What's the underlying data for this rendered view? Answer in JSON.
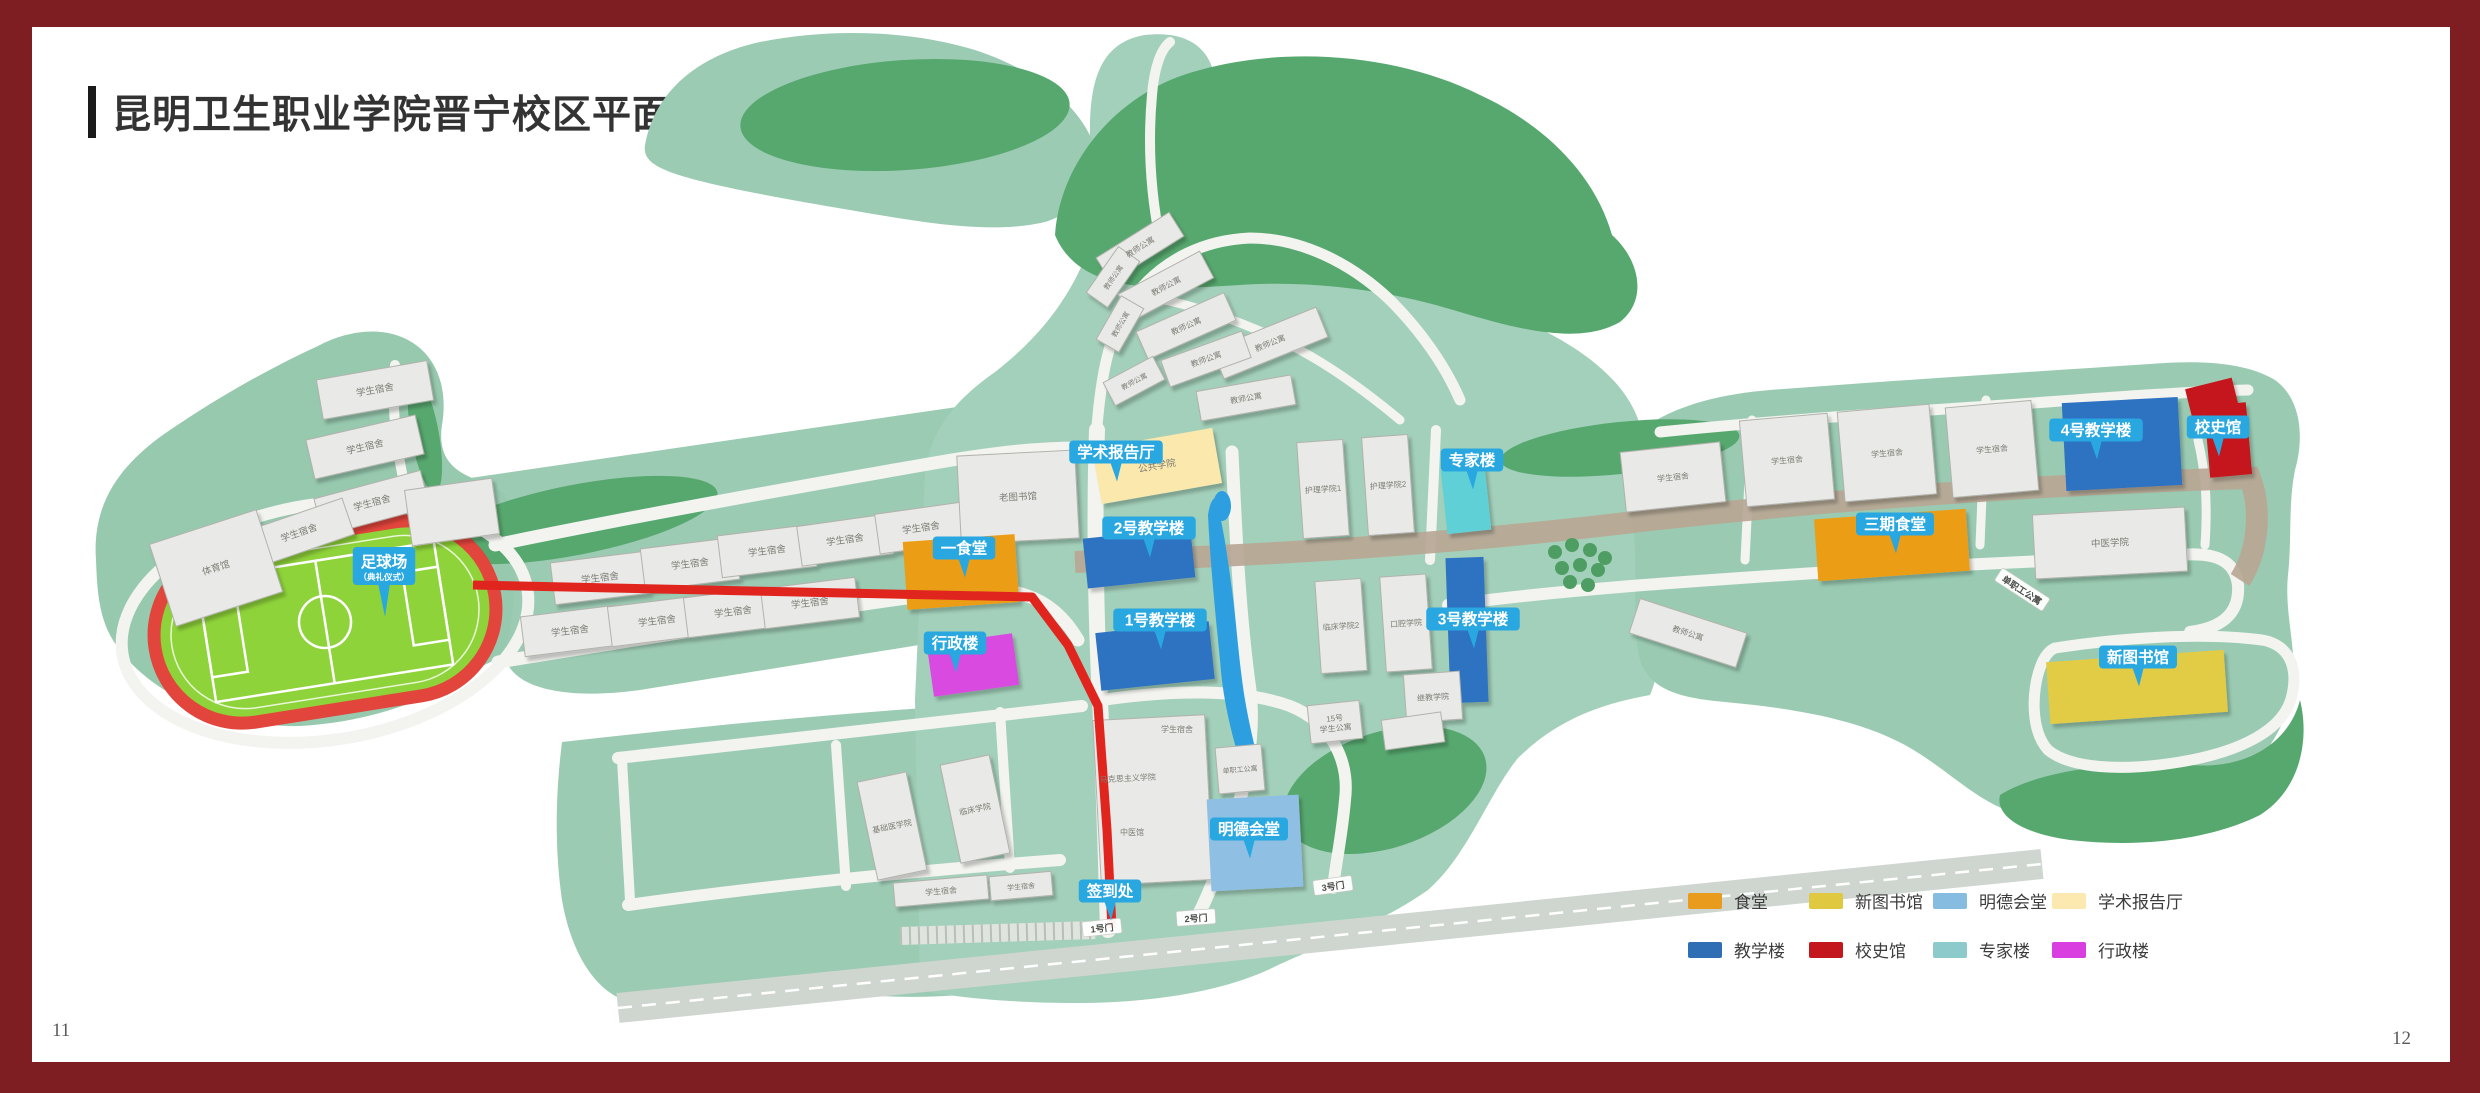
{
  "page": {
    "title": "昆明卫生职业学院晋宁校区平面图",
    "page_left": "11",
    "page_right": "12",
    "frame_color": "#7E1E22"
  },
  "legend": {
    "items": [
      {
        "label": "食堂",
        "color": "#E89B1C"
      },
      {
        "label": "新图书馆",
        "color": "#E0C840"
      },
      {
        "label": "明德会堂",
        "color": "#85BCE0"
      },
      {
        "label": "学术报告厅",
        "color": "#FBE9B0"
      },
      {
        "label": "教学楼",
        "color": "#2F6EB5"
      },
      {
        "label": "校史馆",
        "color": "#C4161D"
      },
      {
        "label": "专家楼",
        "color": "#8CCACB"
      },
      {
        "label": "行政楼",
        "color": "#D93FE0"
      }
    ]
  },
  "map": {
    "colors": {
      "badge": "#29A7E0",
      "route": "#E0251F",
      "gray": "#E9E9E7",
      "gray_stroke": "#B2B2AD",
      "label": "#7d7d76",
      "canteen": "#EC9D17",
      "teaching": "#2E72C2",
      "library": "#E2CB45",
      "history": "#C4161D",
      "hall": "#8FBFE2",
      "lecture": "#FAE8AC",
      "expert": "#5ED1D6",
      "admin": "#D94BE0"
    },
    "route_points": "473,585 1032,597 1068,645 1098,706 1107,830 1112,928",
    "badges": [
      {
        "x": 384,
        "y": 566,
        "t": "足球场",
        "sub": "（典礼仪式）"
      },
      {
        "x": 1116,
        "y": 452,
        "t": "学术报告厅"
      },
      {
        "x": 964,
        "y": 548,
        "t": "一食堂"
      },
      {
        "x": 1149,
        "y": 528,
        "t": "2号教学楼"
      },
      {
        "x": 1160,
        "y": 620,
        "t": "1号教学楼"
      },
      {
        "x": 955,
        "y": 643,
        "t": "行政楼"
      },
      {
        "x": 1472,
        "y": 460,
        "t": "专家楼"
      },
      {
        "x": 1473,
        "y": 619,
        "t": "3号教学楼"
      },
      {
        "x": 1895,
        "y": 524,
        "t": "三期食堂"
      },
      {
        "x": 2096,
        "y": 430,
        "t": "4号教学楼"
      },
      {
        "x": 2218,
        "y": 427,
        "t": "校史馆"
      },
      {
        "x": 2138,
        "y": 657,
        "t": "新图书馆"
      },
      {
        "x": 1249,
        "y": 829,
        "t": "明德会堂"
      },
      {
        "x": 1110,
        "y": 891,
        "t": "签到处"
      }
    ],
    "gates": [
      {
        "x": 1102,
        "y": 928,
        "t": "1号门",
        "r": -6
      },
      {
        "x": 1196,
        "y": 918,
        "t": "2号门",
        "r": -4
      },
      {
        "x": 1333,
        "y": 886,
        "t": "3号门",
        "r": -8
      }
    ],
    "road_labels": [
      {
        "x": 2022,
        "y": 590,
        "t": "单职工公寓",
        "r": 33
      }
    ],
    "free_labels": [
      {
        "x": 1177,
        "y": 732,
        "t": "学生宿舍",
        "fs": 8
      },
      {
        "x": 1128,
        "y": 781,
        "t": "马克思主义学院",
        "fs": 8,
        "r": -3
      },
      {
        "x": 1132,
        "y": 835,
        "t": "中医馆",
        "fs": 8
      }
    ],
    "buildings": [
      {
        "x": 375,
        "y": 390,
        "w": 112,
        "h": 40,
        "r": -10,
        "label": "学生宿舍"
      },
      {
        "x": 365,
        "y": 447,
        "w": 112,
        "h": 40,
        "r": -13,
        "label": "学生宿舍"
      },
      {
        "x": 372,
        "y": 503,
        "w": 110,
        "h": 38,
        "r": -15,
        "label": "学生宿舍"
      },
      {
        "x": 299,
        "y": 533,
        "w": 104,
        "h": 38,
        "r": -19,
        "label": "学生宿舍"
      },
      {
        "x": 216,
        "y": 568,
        "w": 112,
        "h": 86,
        "r": -18,
        "label": "体育馆"
      },
      {
        "x": 452,
        "y": 512,
        "w": 88,
        "h": 56,
        "r": -8
      },
      {
        "x": 600,
        "y": 578,
        "w": 95,
        "h": 42,
        "r": -7,
        "label": "学生宿舍"
      },
      {
        "x": 690,
        "y": 564,
        "w": 95,
        "h": 42,
        "r": -7,
        "label": "学生宿舍"
      },
      {
        "x": 767,
        "y": 551,
        "w": 95,
        "h": 42,
        "r": -7,
        "label": "学生宿舍"
      },
      {
        "x": 845,
        "y": 540,
        "w": 92,
        "h": 40,
        "r": -8,
        "label": "学生宿舍"
      },
      {
        "x": 921,
        "y": 528,
        "w": 88,
        "h": 40,
        "r": -8,
        "label": "学生宿舍"
      },
      {
        "x": 570,
        "y": 631,
        "w": 95,
        "h": 40,
        "r": -7,
        "label": "学生宿舍"
      },
      {
        "x": 657,
        "y": 621,
        "w": 95,
        "h": 40,
        "r": -7,
        "label": "学生宿舍"
      },
      {
        "x": 733,
        "y": 612,
        "w": 95,
        "h": 40,
        "r": -7,
        "label": "学生宿舍"
      },
      {
        "x": 810,
        "y": 603,
        "w": 95,
        "h": 40,
        "r": -7,
        "label": "学生宿舍"
      },
      {
        "x": 1018,
        "y": 497,
        "w": 118,
        "h": 88,
        "r": -3,
        "label": "老图书馆"
      },
      {
        "x": 1157,
        "y": 466,
        "w": 122,
        "h": 56,
        "r": -10,
        "c": "lecture",
        "label": "公共学院"
      },
      {
        "x": 961,
        "y": 572,
        "w": 112,
        "h": 68,
        "r": -4,
        "c": "canteen"
      },
      {
        "x": 973,
        "y": 665,
        "w": 86,
        "h": 52,
        "r": -8,
        "c": "admin"
      },
      {
        "x": 1139,
        "y": 558,
        "w": 108,
        "h": 50,
        "r": -6,
        "c": "teaching"
      },
      {
        "x": 1155,
        "y": 656,
        "w": 114,
        "h": 58,
        "r": -6,
        "c": "teaching"
      },
      {
        "x": 1323,
        "y": 489,
        "w": 46,
        "h": 96,
        "r": -4,
        "label": "护理学院1",
        "fs": 8
      },
      {
        "x": 1388,
        "y": 485,
        "w": 46,
        "h": 98,
        "r": -4,
        "label": "护理学院2",
        "fs": 8
      },
      {
        "x": 1341,
        "y": 626,
        "w": 46,
        "h": 92,
        "r": -4,
        "label": "临床学院2",
        "fs": 8
      },
      {
        "x": 1406,
        "y": 623,
        "w": 46,
        "h": 95,
        "r": -4,
        "label": "口腔学院",
        "fs": 8
      },
      {
        "x": 1466,
        "y": 500,
        "w": 44,
        "h": 64,
        "r": -6,
        "c": "expert"
      },
      {
        "x": 1467,
        "y": 630,
        "w": 38,
        "h": 145,
        "r": -2,
        "c": "teaching"
      },
      {
        "x": 1433,
        "y": 697,
        "w": 56,
        "h": 48,
        "r": -4,
        "label": "继教学院",
        "fs": 8
      },
      {
        "x": 1335,
        "y": 722,
        "w": 52,
        "h": 38,
        "r": -6,
        "label": "15号 学生公寓",
        "fs": 8
      },
      {
        "x": 1413,
        "y": 731,
        "w": 60,
        "h": 30,
        "r": -8
      },
      {
        "x": 1153,
        "y": 800,
        "w": 112,
        "h": 165,
        "r": -3
      },
      {
        "x": 1240,
        "y": 769,
        "w": 46,
        "h": 46,
        "r": -5,
        "label": "单职工公寓",
        "fs": 7
      },
      {
        "x": 1255,
        "y": 843,
        "w": 92,
        "h": 92,
        "r": -3,
        "c": "hall"
      },
      {
        "x": 892,
        "y": 826,
        "w": 50,
        "h": 100,
        "r": -12,
        "label": "基础医学院",
        "fs": 8
      },
      {
        "x": 975,
        "y": 809,
        "w": 50,
        "h": 100,
        "r": -12,
        "label": "临床学院",
        "fs": 8
      },
      {
        "x": 941,
        "y": 891,
        "w": 94,
        "h": 24,
        "r": -5,
        "label": "学生宿舍",
        "fs": 8
      },
      {
        "x": 1021,
        "y": 886,
        "w": 62,
        "h": 24,
        "r": -5,
        "label": "学生宿舍",
        "fs": 7
      },
      {
        "x": 1140,
        "y": 247,
        "w": 86,
        "h": 28,
        "r": -32,
        "label": "教师公寓",
        "fs": 8
      },
      {
        "x": 1113,
        "y": 277,
        "w": 56,
        "h": 26,
        "r": -55,
        "label": "教师公寓",
        "fs": 7
      },
      {
        "x": 1166,
        "y": 286,
        "w": 92,
        "h": 30,
        "r": -28,
        "label": "教师公寓",
        "fs": 8
      },
      {
        "x": 1120,
        "y": 324,
        "w": 50,
        "h": 26,
        "r": -60,
        "label": "教师公寓",
        "fs": 7
      },
      {
        "x": 1186,
        "y": 326,
        "w": 96,
        "h": 30,
        "r": -24,
        "label": "教师公寓",
        "fs": 8
      },
      {
        "x": 1270,
        "y": 343,
        "w": 112,
        "h": 32,
        "r": -22,
        "label": "教师公寓",
        "fs": 8
      },
      {
        "x": 1206,
        "y": 359,
        "w": 86,
        "h": 28,
        "r": -20,
        "label": "教师公寓",
        "fs": 8
      },
      {
        "x": 1134,
        "y": 381,
        "w": 56,
        "h": 26,
        "r": -28,
        "label": "教师公寓",
        "fs": 7
      },
      {
        "x": 1246,
        "y": 398,
        "w": 96,
        "h": 30,
        "r": -10,
        "label": "教师公寓",
        "fs": 8
      },
      {
        "x": 1673,
        "y": 477,
        "w": 100,
        "h": 60,
        "r": -6,
        "label": "学生宿舍",
        "fs": 8
      },
      {
        "x": 1787,
        "y": 460,
        "w": 88,
        "h": 86,
        "r": -5,
        "label": "学生宿舍",
        "fs": 8
      },
      {
        "x": 1887,
        "y": 453,
        "w": 92,
        "h": 90,
        "r": -5,
        "label": "学生宿舍",
        "fs": 8
      },
      {
        "x": 1992,
        "y": 449,
        "w": 86,
        "h": 90,
        "r": -5,
        "label": "学生宿舍",
        "fs": 8
      },
      {
        "x": 2122,
        "y": 444,
        "w": 116,
        "h": 88,
        "r": -3,
        "c": "teaching"
      },
      {
        "x": 2212,
        "y": 398,
        "w": 48,
        "h": 30,
        "r": -14,
        "c": "history"
      },
      {
        "x": 2228,
        "y": 440,
        "w": 42,
        "h": 72,
        "r": -5,
        "c": "history"
      },
      {
        "x": 1892,
        "y": 545,
        "w": 152,
        "h": 62,
        "r": -4,
        "c": "canteen"
      },
      {
        "x": 2110,
        "y": 543,
        "w": 152,
        "h": 64,
        "r": -3,
        "label": "中医学院"
      },
      {
        "x": 1688,
        "y": 633,
        "w": 112,
        "h": 36,
        "r": 18,
        "label": "教师公寓",
        "fs": 8
      },
      {
        "x": 2137,
        "y": 687,
        "w": 178,
        "h": 62,
        "r": -4,
        "c": "library"
      }
    ]
  }
}
